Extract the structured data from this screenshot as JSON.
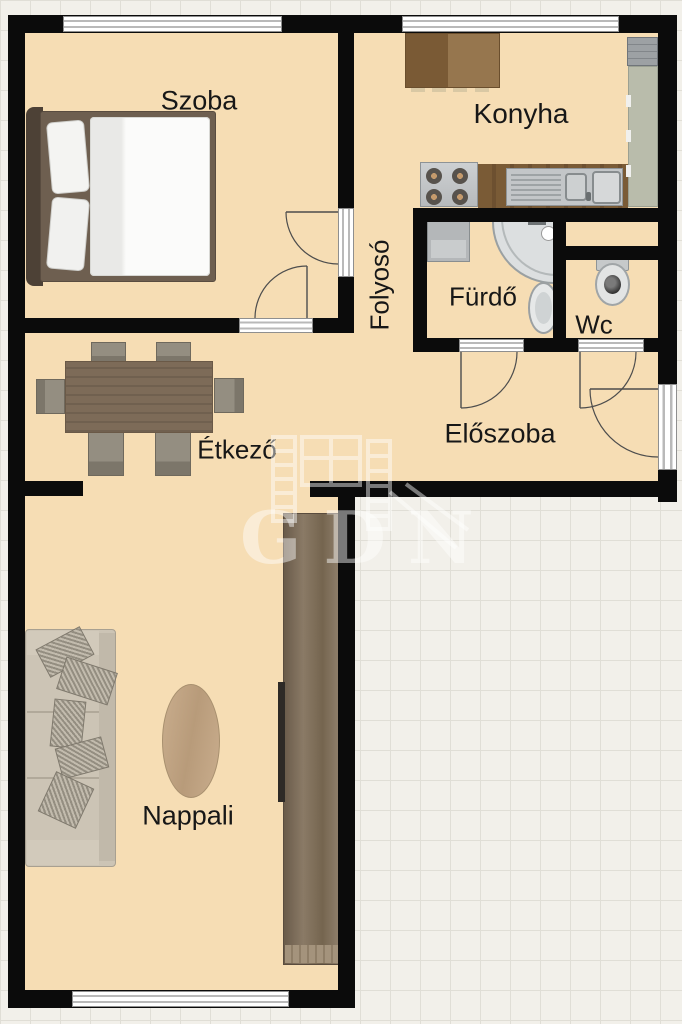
{
  "meta": {
    "kind": "apartment-floor-plan",
    "language": "hu"
  },
  "rooms": {
    "szoba": {
      "label": "Szoba"
    },
    "konyha": {
      "label": "Konyha"
    },
    "folyoso": {
      "label": "Folyosó"
    },
    "furdo": {
      "label": "Fürdő"
    },
    "wc": {
      "label": "Wc"
    },
    "etkezo": {
      "label": "Étkező"
    },
    "eloszoba": {
      "label": "Előszoba"
    },
    "nappali": {
      "label": "Nappali"
    }
  },
  "watermark": {
    "text": "GDN"
  },
  "furniture": {
    "szoba": [
      "double-bed"
    ],
    "konyha": [
      "kitchen-table",
      "stove",
      "sink-counter",
      "refrigerator",
      "tall-cabinet"
    ],
    "furdo": [
      "washing-machine",
      "corner-shower",
      "washbasin"
    ],
    "wc": [
      "toilet"
    ],
    "etkezo": [
      "dining-table",
      "six-chairs"
    ],
    "nappali": [
      "sofa",
      "rug",
      "tv",
      "wardrobe"
    ]
  },
  "colors": {
    "floor": "#f6ddb4",
    "wall": "#0b0b0b",
    "grid_bg": "#f2f0ea",
    "grid_line": "#e0ded6",
    "wood_dark": "#8a6a43",
    "counter_wood": "#7a5b36",
    "steel_light": "#c7cacc",
    "cabinet_green": "#b9bcab",
    "table_brown": "#7d6b58",
    "chair_gray": "#8f897c",
    "wardrobe_brown": "#7b6b59",
    "sofa_beige": "#cdc5b6",
    "rug_tan": "#c3a787",
    "bed_frame": "#6e5f50",
    "label_text": "#171717",
    "watermark_white": "rgba(255,255,255,0.45)"
  }
}
